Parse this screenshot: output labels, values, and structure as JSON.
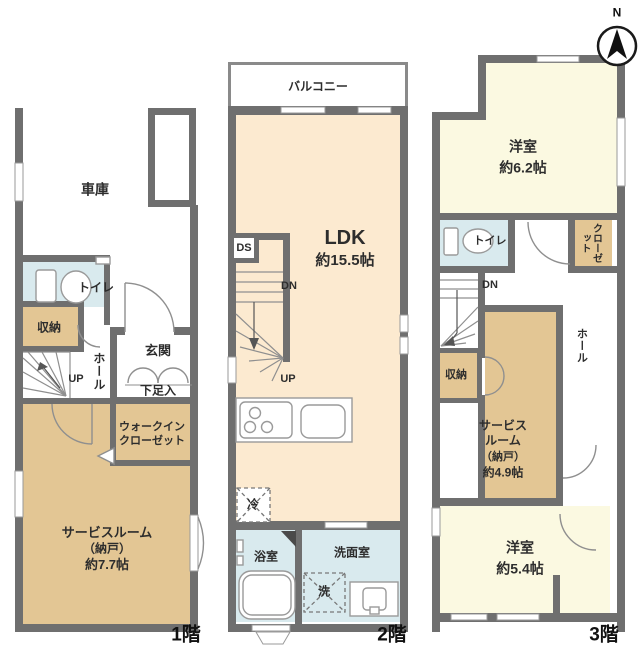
{
  "meta": {
    "type": "japanese-floor-plan",
    "floors": 3
  },
  "compass": {
    "north": "N"
  },
  "colors": {
    "wall": "#6f6f6f",
    "room_cream": "#fcead0",
    "room_tan": "#e3c694",
    "room_yellow": "#fbf9e1",
    "room_wet": "#d9eaee"
  },
  "floor1": {
    "floor_label": "1階",
    "garage": "車庫",
    "toilet": "トイレ",
    "storage": "収納",
    "hall": "ホール",
    "up": "UP",
    "entrance": "玄関",
    "shoe_cabinet": "下足入",
    "wic_line1": "ウォークイン",
    "wic_line2": "クローゼット",
    "service_line1": "サービスルーム",
    "service_line2": "（納戸）",
    "service_line3": "約7.7帖"
  },
  "floor2": {
    "floor_label": "2階",
    "balcony": "バルコニー",
    "ldk_name": "LDK",
    "ldk_size": "約15.5帖",
    "duct": "DS",
    "dn": "DN",
    "up": "UP",
    "fridge": "冷",
    "bathroom": "浴室",
    "washroom": "洗面室",
    "washer": "洗"
  },
  "floor3": {
    "floor_label": "3階",
    "room_a_name": "洋室",
    "room_a_size": "約6.2帖",
    "toilet": "トイレ",
    "closet": "クローゼット",
    "dn": "DN",
    "storage": "収納",
    "service_line1": "サービス",
    "service_line2": "ルーム",
    "service_line3": "（納戸）",
    "service_line4": "約4.9帖",
    "hall": "ホール",
    "room_b_name": "洋室",
    "room_b_size": "約5.4帖"
  }
}
